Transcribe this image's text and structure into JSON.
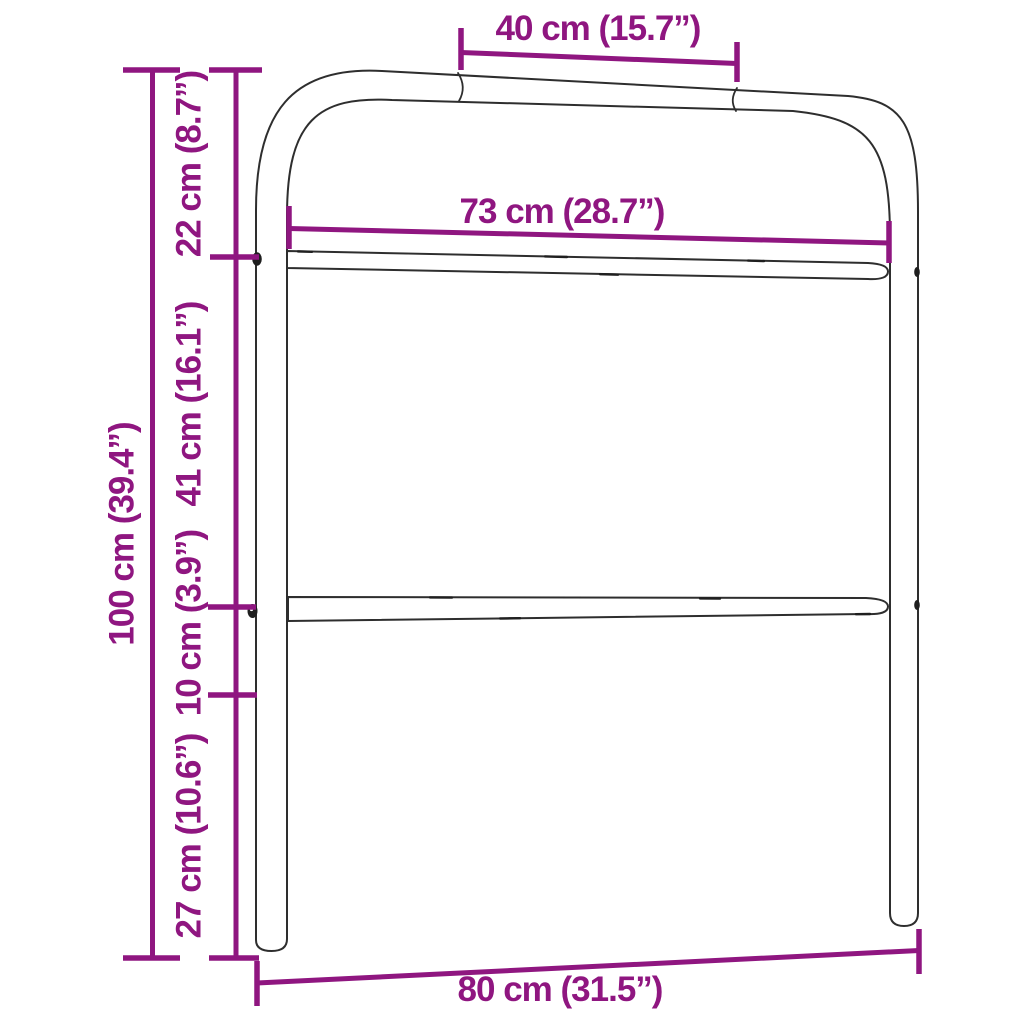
{
  "diagram": {
    "subject": "metal headboard dimension drawing",
    "colors": {
      "dimension_accent": "#8f1680",
      "outline": "#2e2e2e",
      "background": "#ffffff"
    },
    "dimensions": {
      "top_bar_section": {
        "cm": "40",
        "inch": "15.7",
        "label": "40 cm (15.7”)"
      },
      "inner_width": {
        "cm": "73",
        "inch": "28.7",
        "label": "73 cm (28.7”)"
      },
      "overall_width": {
        "cm": "80",
        "inch": "31.5",
        "label": "80 cm (31.5”)"
      },
      "overall_height": {
        "cm": "100",
        "inch": "39.4",
        "label": "100 cm (39.4”)"
      },
      "top_section": {
        "cm": "22",
        "inch": "8.7",
        "label": "22 cm (8.7”)"
      },
      "panel_section": {
        "cm": "41",
        "inch": "16.1",
        "label": "41 cm (16.1”)"
      },
      "rail_gap": {
        "cm": "10",
        "inch": "3.9",
        "label": "10 cm (3.9”)"
      },
      "leg_section": {
        "cm": "27",
        "inch": "10.6",
        "label": "27 cm (10.6”)"
      }
    }
  }
}
